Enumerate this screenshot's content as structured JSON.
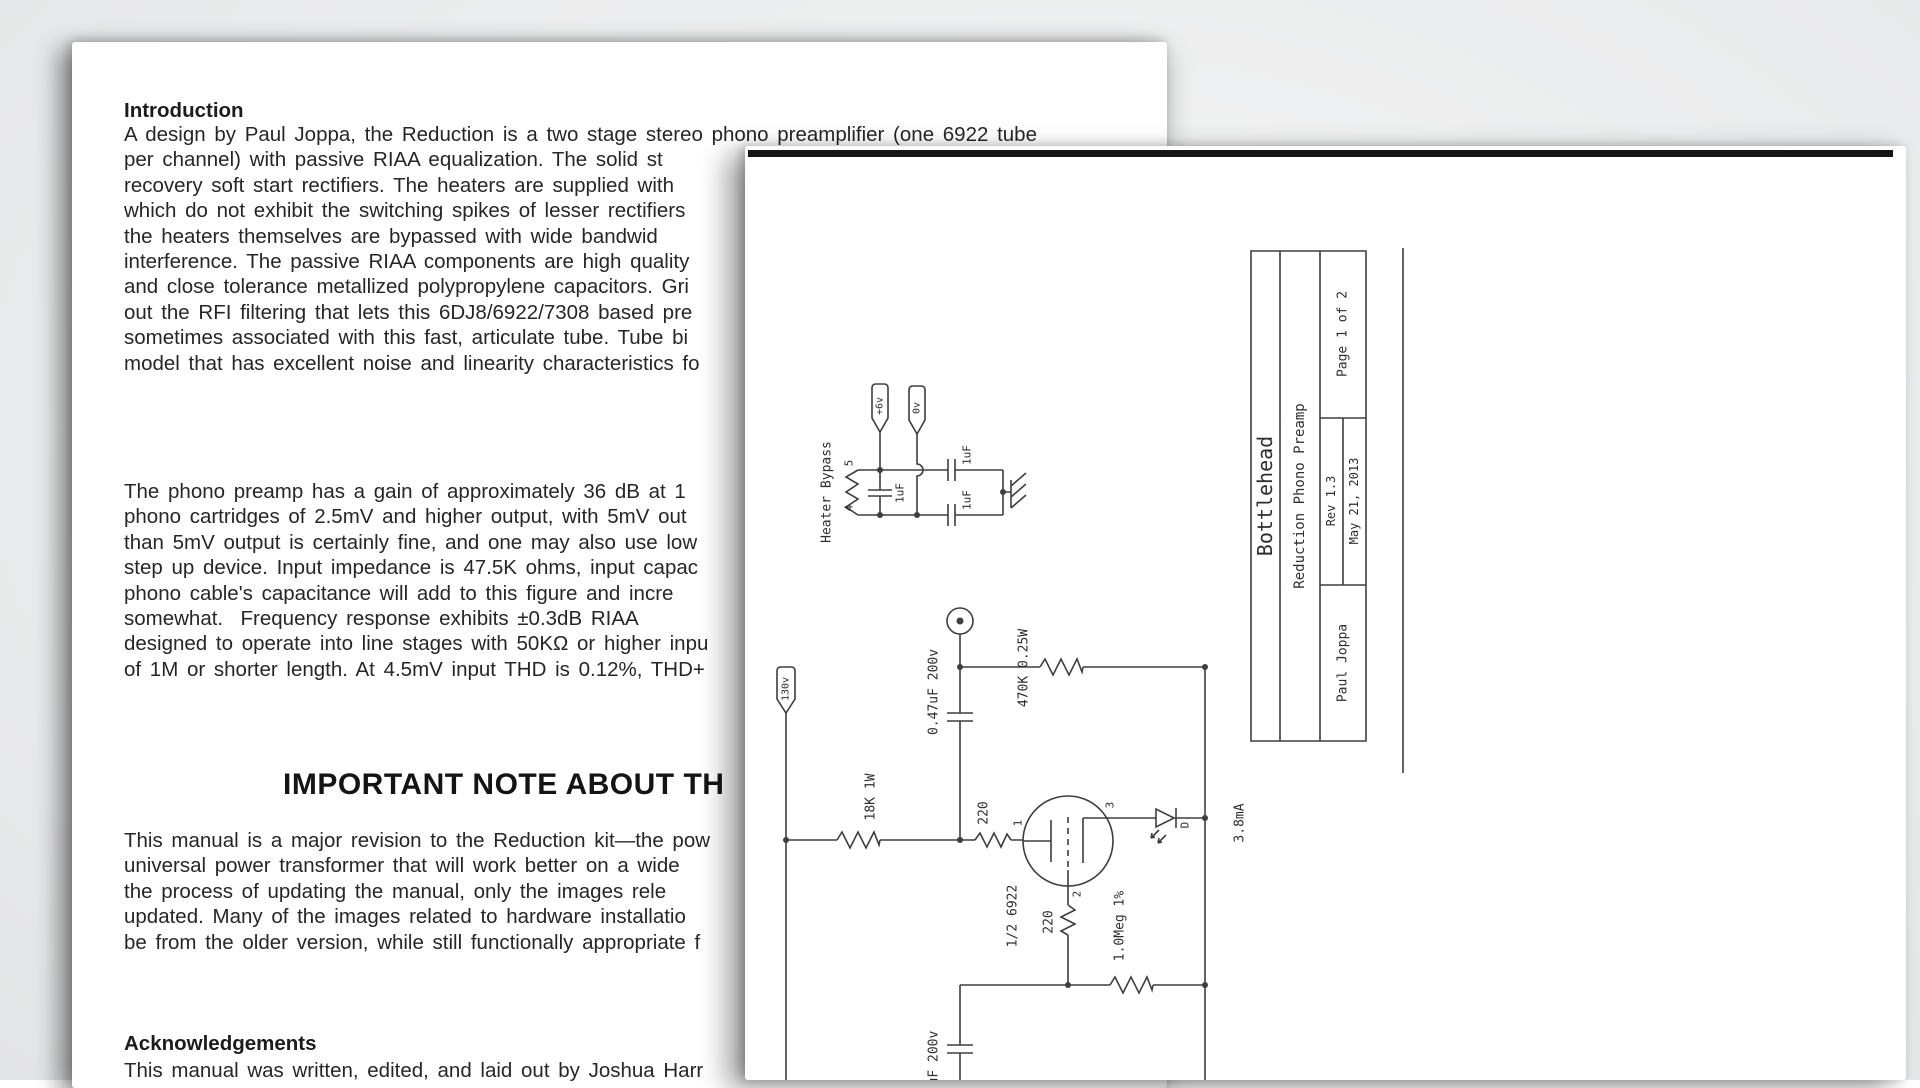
{
  "colors": {
    "paper": "#ffffff",
    "doc_ink": "#262626",
    "schematic_ink": "#3e3e3e"
  },
  "doc": {
    "intro_heading": "Introduction",
    "p1": {
      "lines": [
        "A design by Paul Joppa, the Reduction is a two stage stereo phono preamplifier (one 6922 tube",
        "per channel) with passive RIAA equalization. The solid st",
        "recovery soft start rectifiers. The heaters are supplied with",
        "which do not exhibit the switching spikes of lesser rectifiers",
        "the heaters themselves are bypassed with wide bandwid",
        "interference. The passive RIAA components are high quality",
        "and close tolerance metallized polypropylene capacitors. Gri",
        "out the RFI filtering that lets this 6DJ8/6922/7308 based pre",
        "sometimes associated with this fast, articulate tube. Tube bi",
        "model that has excellent noise and linearity characteristics fo"
      ]
    },
    "p2": {
      "lines": [
        "The phono preamp has a gain of approximately 36 dB at 1",
        "phono cartridges of 2.5mV and higher output, with 5mV out",
        "than 5mV output is certainly fine, and one may also use low",
        "step up device. Input impedance is 47.5K ohms, input capac",
        "phono cable's capacitance will add to this figure and incre",
        "somewhat.  Frequency response exhibits ±0.3dB RIAA",
        "designed to operate into line stages with 50KΩ or higher inpu",
        "of 1M or shorter length. At 4.5mV input THD is 0.12%, THD+"
      ]
    },
    "note_heading": "IMPORTANT NOTE ABOUT TH",
    "p3": {
      "lines": [
        "This manual is a major revision to the Reduction kit—the pow",
        "universal power transformer that will work better on a wide",
        "the process of updating the manual, only the images rele",
        "updated. Many of the images related to hardware installatio",
        "be from the older version, while still functionally appropriate f"
      ]
    },
    "ack_heading": "Acknowledgements",
    "ack_line": "This manual was written, edited, and laid out by Joshua Harr"
  },
  "schematic": {
    "title_block": {
      "company": "Bottlehead",
      "title": "Reduction Phono Preamp",
      "page": "Page 1 of 2",
      "rev": "Rev 1.3",
      "date": "May 21, 2013",
      "author": "Paul Joppa"
    },
    "heater": {
      "label": "Heater Bypass",
      "flag_plus": "+6v",
      "flag_zero": "0v",
      "pin_top": "5",
      "pin_bottom": "4",
      "cap_left": "1uF",
      "cap_top": "1uF",
      "cap_bottom": "1uF"
    },
    "main": {
      "supply_flag": "130v",
      "plate_resistor": "18K 1W",
      "coupling_cap": "0.47uF 200v",
      "load_resistor": "470K 0.25W",
      "plate_stopper": "220",
      "pin_plate": "1",
      "pin_grid": "2",
      "pin_cathode": "3",
      "tube": "1/2 6922",
      "cathode_resistor": "220",
      "grid_leak": "1.0Meg 1%",
      "led": "D",
      "current": "3.8mA",
      "riaa_cap": "1uF 200v"
    }
  }
}
